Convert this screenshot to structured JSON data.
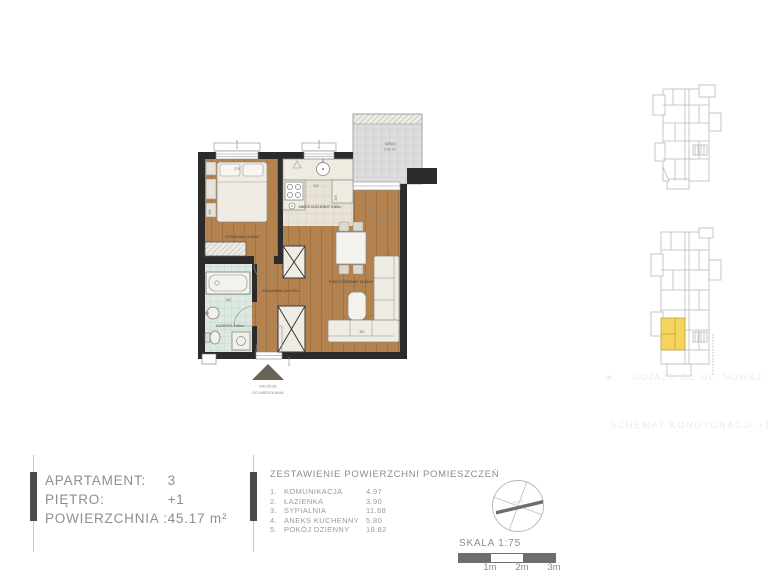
{
  "info_panel": {
    "rows": [
      {
        "label": "APARTAMENT:",
        "value": "3"
      },
      {
        "label": "PIĘTRO:",
        "value": "+1"
      },
      {
        "label": "POWIERZCHNIA :",
        "value": "45.17 m²"
      }
    ]
  },
  "areas_table": {
    "title": "ZESTAWIENIE POWIERZCHNI  POMIESZCZEŃ",
    "rows": [
      {
        "no": "1.",
        "name": "KOMUNIKACJA",
        "area": "4.97"
      },
      {
        "no": "2.",
        "name": "ŁAZIENKA",
        "area": "3.90"
      },
      {
        "no": "3.",
        "name": "SYPIALNIA",
        "area": "11.68"
      },
      {
        "no": "4.",
        "name": "ANEKS KUCHENNY",
        "area": "5.80"
      },
      {
        "no": "5.",
        "name": "POKÓJ DZIENNY",
        "area": "18.82"
      }
    ]
  },
  "scale_block": {
    "label": "SKALA 1:75",
    "ticks": [
      "1m",
      "2m",
      "3m"
    ]
  },
  "compass": {
    "north_label": "PÓŁNOC"
  },
  "floor_plan": {
    "room_labels": {
      "bedroom": "SYPIALNIA 11.68m²",
      "kitchen": "ANEKS KUCHENNY 5.80m²",
      "living": "POKÓJ DZIENNY 18.82m²",
      "hall": "KOMUNIKACJA 4.97m²",
      "bathroom": "ŁAZIENKA 3.90m²",
      "terrace_name": "TARAS",
      "terrace_area": "3.50 m²"
    },
    "entrance": {
      "line1": "WEJŚCIE",
      "line2": "DO MIESZKANIA"
    },
    "dimensions": {
      "bedroom_w": "275",
      "bedroom_h": "409",
      "kitchen_h": "243",
      "kitchen_w": "343",
      "bath_w": "155",
      "living_h": "577",
      "living_w": "367"
    },
    "window_marks": {
      "w1": "90/150",
      "w2": "90/150",
      "entry": "90/210"
    }
  },
  "key_plans": {
    "street_arrow": "◄",
    "street_note": "DOJAZD DO UL. NOWEJ",
    "caption": "SCHEMAT KONDYGNACJI +1"
  },
  "colors": {
    "wood_floor": "#b3824e",
    "bathroom_tile": "#dbe9e2",
    "kitchen_tile": "#e8e3d6",
    "terrace": "#dddddd",
    "wall": "#2b2b2b",
    "text_gray": "#8c8c8c",
    "bar_gray": "#6e6e6e",
    "highlight_yellow": "#f4d45c"
  }
}
